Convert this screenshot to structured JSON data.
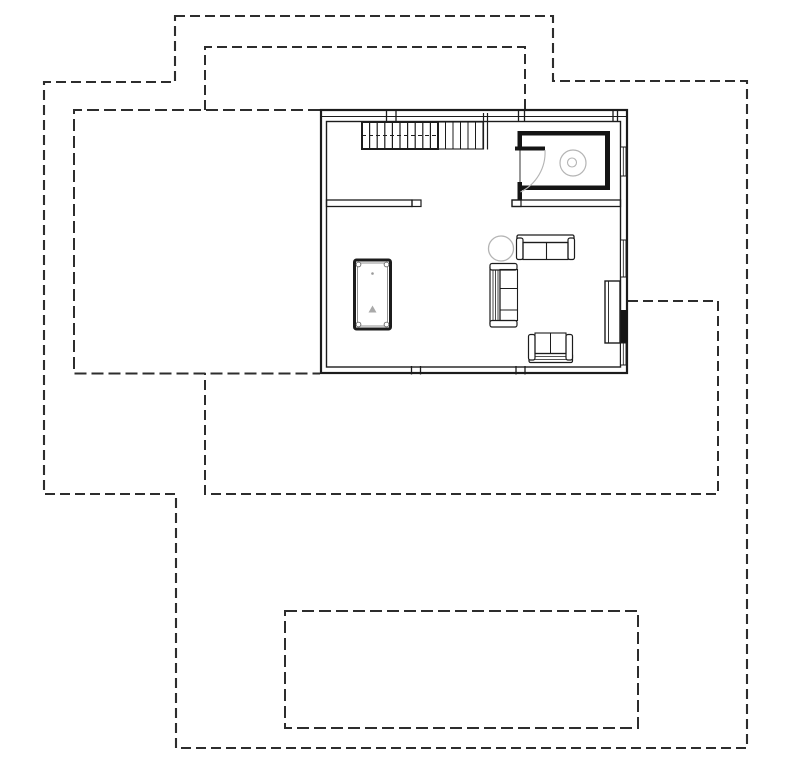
{
  "canvas": {
    "width": 800,
    "height": 763,
    "background": "#ffffff"
  },
  "colors": {
    "line": "#1c1c1c",
    "dashed_outline": "#2d2d2d",
    "wall_fill": "#141414",
    "fixture_gray": "#b4b4b4",
    "detail_gray": "#8f8f8f"
  },
  "drawing": {
    "shapes": [
      {
        "type": "path",
        "name": "site-boundary-outer",
        "d": "M175,16 L553,16 L553,81 L747,81 L747,748 L176,748 L176,494 L44,494 L44,82 L175,82 Z",
        "stroke": "#2d2d2d",
        "sw": 2.1,
        "dash": "10 5"
      },
      {
        "type": "path",
        "name": "roof-overhang-upper",
        "d": "M205,110 L205,47 L525,47 L525,110",
        "stroke": "#2d2d2d",
        "sw": 2,
        "dash": "10 5"
      },
      {
        "type": "path",
        "name": "roof-overhang-lower",
        "d": "M628,301 L718,301 L718,494 L205,494 L205,373",
        "stroke": "#2d2d2d",
        "sw": 2,
        "dash": "10 5"
      },
      {
        "type": "path",
        "name": "terrace-left-outline",
        "d": "M320,110 L74,110 L74,373.5 L320,373.5",
        "stroke": "#2d2d2d",
        "sw": 2,
        "dash": "12 5"
      },
      {
        "type": "path",
        "name": "terrace-lower-outline",
        "d": "M285,611 L638,611 L638,728 L285,728 Z",
        "stroke": "#2d2d2d",
        "sw": 2,
        "dash": "12 5"
      },
      {
        "type": "rect",
        "name": "exterior-wall-outer",
        "x": 321,
        "y": 110,
        "w": 306,
        "h": 263,
        "sw": 2.2
      },
      {
        "type": "rect",
        "name": "exterior-wall-inner",
        "x": 326.5,
        "y": 121.5,
        "w": 294,
        "h": 245.5,
        "sw": 1.4
      },
      {
        "type": "line",
        "name": "exterior-wall-top-midline",
        "x1": 321,
        "y1": 116.5,
        "x2": 627,
        "y2": 116.5,
        "sw": 1.1
      },
      {
        "type": "line",
        "name": "wall-tick",
        "x1": 386.5,
        "y1": 110,
        "x2": 386.5,
        "y2": 122,
        "sw": 1.3
      },
      {
        "type": "line",
        "name": "wall-tick",
        "x1": 396,
        "y1": 110,
        "x2": 396,
        "y2": 122,
        "sw": 1.3
      },
      {
        "type": "line",
        "name": "wall-tick",
        "x1": 518.5,
        "y1": 110,
        "x2": 518.5,
        "y2": 122,
        "sw": 1.3
      },
      {
        "type": "line",
        "name": "wall-tick",
        "x1": 524.5,
        "y1": 110,
        "x2": 524.5,
        "y2": 122,
        "sw": 1.3
      },
      {
        "type": "line",
        "name": "wall-tick",
        "x1": 613,
        "y1": 110,
        "x2": 613,
        "y2": 122,
        "sw": 1.3
      },
      {
        "type": "line",
        "name": "wall-tick",
        "x1": 617.5,
        "y1": 110,
        "x2": 617.5,
        "y2": 122,
        "sw": 1.3
      },
      {
        "type": "line",
        "name": "wall-tick",
        "x1": 411.5,
        "y1": 366,
        "x2": 411.5,
        "y2": 374.5,
        "sw": 1.3
      },
      {
        "type": "line",
        "name": "wall-tick",
        "x1": 420.5,
        "y1": 366,
        "x2": 420.5,
        "y2": 374.5,
        "sw": 1.3
      },
      {
        "type": "line",
        "name": "wall-tick",
        "x1": 516,
        "y1": 366,
        "x2": 516,
        "y2": 374.5,
        "sw": 1.3
      },
      {
        "type": "line",
        "name": "wall-tick",
        "x1": 525,
        "y1": 366,
        "x2": 525,
        "y2": 374.5,
        "sw": 1.3
      },
      {
        "type": "rect",
        "name": "interior-wall-left",
        "x": 326.5,
        "y": 200,
        "w": 85.5,
        "h": 6.5,
        "sw": 1.3
      },
      {
        "type": "rect",
        "name": "interior-wall-left-endcap",
        "x": 412,
        "y": 200,
        "w": 9,
        "h": 6.5,
        "sw": 1.2
      },
      {
        "type": "rect",
        "name": "interior-wall-right",
        "x": 512,
        "y": 200,
        "w": 108.5,
        "h": 6.5,
        "sw": 1.3
      },
      {
        "type": "rect",
        "name": "interior-wall-right-endcap",
        "x": 512,
        "y": 200,
        "w": 9,
        "h": 6.5,
        "sw": 1.2
      },
      {
        "type": "rect",
        "name": "stair-flight-left",
        "x": 362,
        "y": 122,
        "w": 76,
        "h": 27,
        "sw": 2
      },
      {
        "type": "line",
        "name": "stair-tread",
        "x1": 369.6,
        "y1": 122,
        "x2": 369.6,
        "y2": 149,
        "sw": 1.2
      },
      {
        "type": "line",
        "name": "stair-tread",
        "x1": 377.2,
        "y1": 122,
        "x2": 377.2,
        "y2": 149,
        "sw": 1.2
      },
      {
        "type": "line",
        "name": "stair-tread",
        "x1": 384.8,
        "y1": 122,
        "x2": 384.8,
        "y2": 149,
        "sw": 1.2
      },
      {
        "type": "line",
        "name": "stair-tread",
        "x1": 392.4,
        "y1": 122,
        "x2": 392.4,
        "y2": 149,
        "sw": 1.2
      },
      {
        "type": "line",
        "name": "stair-tread",
        "x1": 400,
        "y1": 122,
        "x2": 400,
        "y2": 149,
        "sw": 1.2
      },
      {
        "type": "line",
        "name": "stair-tread",
        "x1": 407.6,
        "y1": 122,
        "x2": 407.6,
        "y2": 149,
        "sw": 1.2
      },
      {
        "type": "line",
        "name": "stair-tread",
        "x1": 415.2,
        "y1": 122,
        "x2": 415.2,
        "y2": 149,
        "sw": 1.2
      },
      {
        "type": "line",
        "name": "stair-tread",
        "x1": 422.8,
        "y1": 122,
        "x2": 422.8,
        "y2": 149,
        "sw": 1.2
      },
      {
        "type": "line",
        "name": "stair-tread",
        "x1": 430.4,
        "y1": 122,
        "x2": 430.4,
        "y2": 149,
        "sw": 1.2
      },
      {
        "type": "line",
        "name": "stair-walkline",
        "x1": 362,
        "y1": 135.5,
        "x2": 438,
        "y2": 135.5,
        "sw": 1,
        "dash": "4 3"
      },
      {
        "type": "rect",
        "name": "stair-flight-right",
        "x": 438,
        "y": 122,
        "w": 45,
        "h": 27,
        "sw": 1.1
      },
      {
        "type": "line",
        "name": "stair-tread",
        "x1": 445.5,
        "y1": 122,
        "x2": 445.5,
        "y2": 149,
        "sw": 1
      },
      {
        "type": "line",
        "name": "stair-tread",
        "x1": 453,
        "y1": 122,
        "x2": 453,
        "y2": 149,
        "sw": 1
      },
      {
        "type": "line",
        "name": "stair-tread",
        "x1": 460.5,
        "y1": 122,
        "x2": 460.5,
        "y2": 149,
        "sw": 1
      },
      {
        "type": "line",
        "name": "stair-tread",
        "x1": 468,
        "y1": 122,
        "x2": 468,
        "y2": 149,
        "sw": 1
      },
      {
        "type": "line",
        "name": "stair-tread",
        "x1": 475.5,
        "y1": 122,
        "x2": 475.5,
        "y2": 149,
        "sw": 1
      },
      {
        "type": "line",
        "name": "stair-cut-line",
        "x1": 483.5,
        "y1": 113,
        "x2": 483.5,
        "y2": 149.5,
        "sw": 1.2
      },
      {
        "type": "line",
        "name": "stair-cut-line",
        "x1": 487.5,
        "y1": 113,
        "x2": 487.5,
        "y2": 149.5,
        "sw": 1.2
      },
      {
        "type": "rect",
        "name": "bathroom-wall-top",
        "x": 517.5,
        "y": 131,
        "w": 92.5,
        "h": 4.5,
        "fill": "#141414",
        "stroke": "none"
      },
      {
        "type": "rect",
        "name": "bathroom-wall-left-upper",
        "x": 517.5,
        "y": 131,
        "w": 4.5,
        "h": 17.5,
        "fill": "#141414",
        "stroke": "none"
      },
      {
        "type": "rect",
        "name": "bathroom-door-leaf",
        "x": 515,
        "y": 146.5,
        "w": 30,
        "h": 4,
        "fill": "#141414",
        "stroke": "none"
      },
      {
        "type": "line",
        "name": "bathroom-wall-left-line",
        "x1": 520,
        "y1": 150.5,
        "x2": 520,
        "y2": 183,
        "sw": 0.9
      },
      {
        "type": "rect",
        "name": "bathroom-wall-left-lower",
        "x": 517.5,
        "y": 182,
        "w": 4.5,
        "h": 17.5,
        "fill": "#141414",
        "stroke": "none"
      },
      {
        "type": "rect",
        "name": "bathroom-wall-right",
        "x": 605,
        "y": 131,
        "w": 5,
        "h": 59,
        "fill": "#141414",
        "stroke": "none"
      },
      {
        "type": "rect",
        "name": "bathroom-wall-bottom",
        "x": 520,
        "y": 185.5,
        "w": 90,
        "h": 4.5,
        "fill": "#141414",
        "stroke": "none"
      },
      {
        "type": "path",
        "name": "bathroom-door-swing-arc",
        "d": "M545,150 A44,44 0 0 1 520.5,192",
        "stroke": "#b4b4b4",
        "sw": 1.1
      },
      {
        "type": "circle",
        "name": "toilet-bowl",
        "cx": 573,
        "cy": 163,
        "r": 13,
        "stroke": "#b4b4b4",
        "sw": 1.2
      },
      {
        "type": "circle",
        "name": "toilet-drain",
        "cx": 572,
        "cy": 162.5,
        "r": 4.5,
        "stroke": "#b4b4b4",
        "sw": 1.1
      },
      {
        "type": "rect",
        "name": "window-right-1",
        "x": 620.5,
        "y": 147,
        "w": 5.5,
        "h": 29,
        "sw": 1,
        "fill": "#ffffff"
      },
      {
        "type": "line",
        "name": "window-right-1-pane",
        "x1": 623.3,
        "y1": 147,
        "x2": 623.3,
        "y2": 176,
        "sw": 0.8
      },
      {
        "type": "rect",
        "name": "window-right-2",
        "x": 620.5,
        "y": 240,
        "w": 5.5,
        "h": 37,
        "sw": 1,
        "fill": "#ffffff"
      },
      {
        "type": "line",
        "name": "window-right-2-pane",
        "x1": 623.3,
        "y1": 240,
        "x2": 623.3,
        "y2": 277,
        "sw": 0.8
      },
      {
        "type": "rect",
        "name": "wall-solid-segment",
        "x": 620.5,
        "y": 310,
        "w": 7,
        "h": 33,
        "fill": "#141414",
        "stroke": "none"
      },
      {
        "type": "rect",
        "name": "window-right-3",
        "x": 620.5,
        "y": 343,
        "w": 5.5,
        "h": 22,
        "sw": 1,
        "fill": "#ffffff"
      },
      {
        "type": "line",
        "name": "window-right-3-pane",
        "x1": 623.3,
        "y1": 343,
        "x2": 623.3,
        "y2": 365,
        "sw": 0.8
      },
      {
        "type": "rect",
        "name": "terrace-door-panel",
        "x": 605,
        "y": 281,
        "w": 15,
        "h": 62,
        "sw": 1.4,
        "fill": "#ffffff"
      },
      {
        "type": "line",
        "name": "terrace-door-panel-line",
        "x1": 608.5,
        "y1": 281,
        "x2": 608.5,
        "y2": 343,
        "sw": 0.9
      },
      {
        "type": "rect",
        "name": "billiard-table",
        "x": 354.5,
        "y": 260,
        "w": 36,
        "h": 69,
        "sw": 3,
        "rx": 2
      },
      {
        "type": "rect",
        "name": "billiard-table-inner",
        "x": 357.5,
        "y": 263,
        "w": 30,
        "h": 63,
        "sw": 0.8,
        "stroke": "#777777"
      },
      {
        "type": "circle",
        "name": "billiard-pocket",
        "cx": 358.5,
        "cy": 264.5,
        "r": 2.4,
        "stroke": "#555555",
        "sw": 0.8,
        "fill": "#ffffff"
      },
      {
        "type": "circle",
        "name": "billiard-pocket",
        "cx": 386.5,
        "cy": 264.5,
        "r": 2.4,
        "stroke": "#555555",
        "sw": 0.8,
        "fill": "#ffffff"
      },
      {
        "type": "circle",
        "name": "billiard-pocket",
        "cx": 358.5,
        "cy": 324.5,
        "r": 2.4,
        "stroke": "#555555",
        "sw": 0.8,
        "fill": "#ffffff"
      },
      {
        "type": "circle",
        "name": "billiard-pocket",
        "cx": 386.5,
        "cy": 324.5,
        "r": 2.4,
        "stroke": "#555555",
        "sw": 0.8,
        "fill": "#ffffff"
      },
      {
        "type": "circle",
        "name": "billiard-spot",
        "cx": 372.5,
        "cy": 273.5,
        "r": 1.3,
        "fill": "#999999",
        "stroke": "none"
      },
      {
        "type": "polygon",
        "name": "billiard-rack-mark",
        "points": "368.5,312.5 376.5,312.5 372.5,305.5",
        "fill": "#a9a9a9",
        "stroke": "none"
      },
      {
        "type": "circle",
        "name": "side-table",
        "cx": 501,
        "cy": 248.5,
        "r": 12.5,
        "stroke": "#b4b4b4",
        "sw": 1.3
      },
      {
        "type": "rect",
        "name": "sofa-top-back",
        "x": 517,
        "y": 235,
        "w": 57,
        "h": 7.5,
        "sw": 1.3,
        "rx": 1.5
      },
      {
        "type": "rect",
        "name": "sofa-top-arm-left",
        "x": 516.5,
        "y": 238,
        "w": 6.5,
        "h": 21.5,
        "sw": 1.2,
        "rx": 2,
        "fill": "#ffffff"
      },
      {
        "type": "rect",
        "name": "sofa-top-arm-right",
        "x": 568,
        "y": 238,
        "w": 6.5,
        "h": 21.5,
        "sw": 1.2,
        "rx": 2,
        "fill": "#ffffff"
      },
      {
        "type": "rect",
        "name": "sofa-top-seat",
        "x": 523,
        "y": 242.5,
        "w": 45,
        "h": 17,
        "sw": 1.2
      },
      {
        "type": "line",
        "name": "sofa-top-seat-divider",
        "x1": 546.5,
        "y1": 242.5,
        "x2": 546.5,
        "y2": 259.5,
        "sw": 1.1
      },
      {
        "type": "rect",
        "name": "sofa-left-back",
        "x": 490,
        "y": 265.5,
        "w": 10,
        "h": 60,
        "sw": 1.2,
        "rx": 1.5
      },
      {
        "type": "line",
        "name": "sofa-left-back-line",
        "x1": 493,
        "y1": 266,
        "x2": 493,
        "y2": 325,
        "sw": 0.8
      },
      {
        "type": "line",
        "name": "sofa-left-back-line",
        "x1": 495.5,
        "y1": 266,
        "x2": 495.5,
        "y2": 325,
        "sw": 0.8
      },
      {
        "type": "line",
        "name": "sofa-left-back-line",
        "x1": 498,
        "y1": 266,
        "x2": 498,
        "y2": 325,
        "sw": 0.8
      },
      {
        "type": "rect",
        "name": "sofa-left-arm-top",
        "x": 490,
        "y": 263.5,
        "w": 27,
        "h": 6.5,
        "sw": 1.2,
        "rx": 2,
        "fill": "#ffffff"
      },
      {
        "type": "rect",
        "name": "sofa-left-arm-bottom",
        "x": 490,
        "y": 320.5,
        "w": 27,
        "h": 6.5,
        "sw": 1.2,
        "rx": 2,
        "fill": "#ffffff"
      },
      {
        "type": "rect",
        "name": "sofa-left-seat",
        "x": 500,
        "y": 269.5,
        "w": 17.5,
        "h": 51,
        "sw": 1.1
      },
      {
        "type": "line",
        "name": "sofa-left-seat-divider",
        "x1": 500,
        "y1": 288.5,
        "x2": 517.5,
        "y2": 288.5,
        "sw": 1
      },
      {
        "type": "line",
        "name": "sofa-left-seat-divider",
        "x1": 500,
        "y1": 310,
        "x2": 517.5,
        "y2": 310,
        "sw": 1
      },
      {
        "type": "rect",
        "name": "sofa-bottom-back",
        "x": 529,
        "y": 353.5,
        "w": 43.5,
        "h": 9,
        "sw": 1.2,
        "rx": 1.5
      },
      {
        "type": "line",
        "name": "sofa-bottom-back-line",
        "x1": 530,
        "y1": 356.5,
        "x2": 572,
        "y2": 356.5,
        "sw": 0.7
      },
      {
        "type": "line",
        "name": "sofa-bottom-back-line",
        "x1": 530,
        "y1": 359.5,
        "x2": 572,
        "y2": 359.5,
        "sw": 0.7
      },
      {
        "type": "rect",
        "name": "sofa-bottom-arm-left",
        "x": 528.5,
        "y": 334.5,
        "w": 6.5,
        "h": 25.5,
        "sw": 1.2,
        "rx": 2,
        "fill": "#ffffff"
      },
      {
        "type": "rect",
        "name": "sofa-bottom-arm-right",
        "x": 566,
        "y": 334.5,
        "w": 6.5,
        "h": 25.5,
        "sw": 1.2,
        "rx": 2,
        "fill": "#ffffff"
      },
      {
        "type": "rect",
        "name": "sofa-bottom-seat",
        "x": 535,
        "y": 333,
        "w": 31,
        "h": 20.5,
        "sw": 1.1
      },
      {
        "type": "line",
        "name": "sofa-bottom-seat-divider",
        "x1": 550.5,
        "y1": 333,
        "x2": 550.5,
        "y2": 353.5,
        "sw": 1
      }
    ]
  }
}
